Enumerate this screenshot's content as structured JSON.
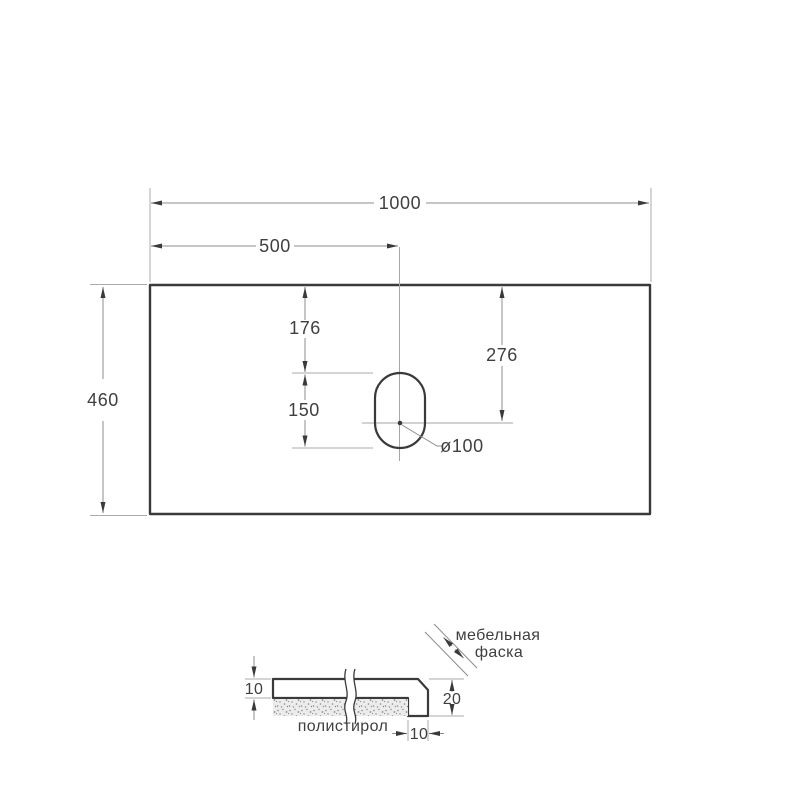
{
  "drawing": {
    "type": "countertop technical drawing",
    "colors": {
      "outline": "#3a3a3a",
      "dimension_line": "#8c8c8c",
      "extension_line": "#ababab",
      "text": "#3f3f3f",
      "hatch": "#4a4a4a",
      "stipple_background": "#ececec",
      "stipple_dot": "#8a8a8a",
      "background": "#ffffff"
    }
  },
  "main_view": {
    "description": "top view of countertop with faucet hole",
    "dim_width": "1000",
    "dim_center": "500",
    "dim_depth": "460",
    "dim_hole_top": "176",
    "dim_hole_len": "150",
    "dim_center_top": "276",
    "hole_dia": "ø100"
  },
  "section_view": {
    "description": "edge cross-section detail",
    "dim_top_thickness": "10",
    "dim_edge_height": "20",
    "dim_edge_width": "10",
    "label_polystyrene": "полистирол",
    "label_chamfer1": "мебельная",
    "label_chamfer2": "фаска"
  }
}
